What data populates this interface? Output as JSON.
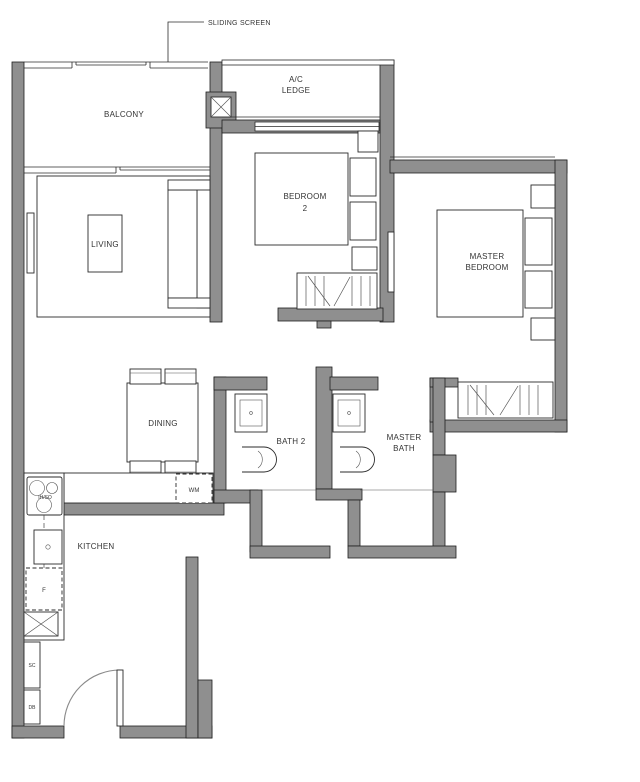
{
  "plan": {
    "annotations": {
      "sliding_screen": "SLIDING SCREEN"
    },
    "rooms": {
      "balcony": "BALCONY",
      "ac_ledge_line1": "A/C",
      "ac_ledge_line2": "LEDGE",
      "living": "LIVING",
      "bedroom2_line1": "BEDROOM",
      "bedroom2_line2": "2",
      "master_bedroom_line1": "MASTER",
      "master_bedroom_line2": "BEDROOM",
      "dining": "DINING",
      "bath2": "BATH 2",
      "master_bath_line1": "MASTER",
      "master_bath_line2": "BATH",
      "kitchen": "KITCHEN"
    },
    "fixtures": {
      "washing_machine": "WM",
      "fridge": "F",
      "hob": "IH/SO",
      "shoe_cabinet": "SC",
      "distribution_board": "DB"
    },
    "colors": {
      "wall": "#8f8f8f",
      "line": "#2b2b2b",
      "background": "#ffffff"
    }
  }
}
